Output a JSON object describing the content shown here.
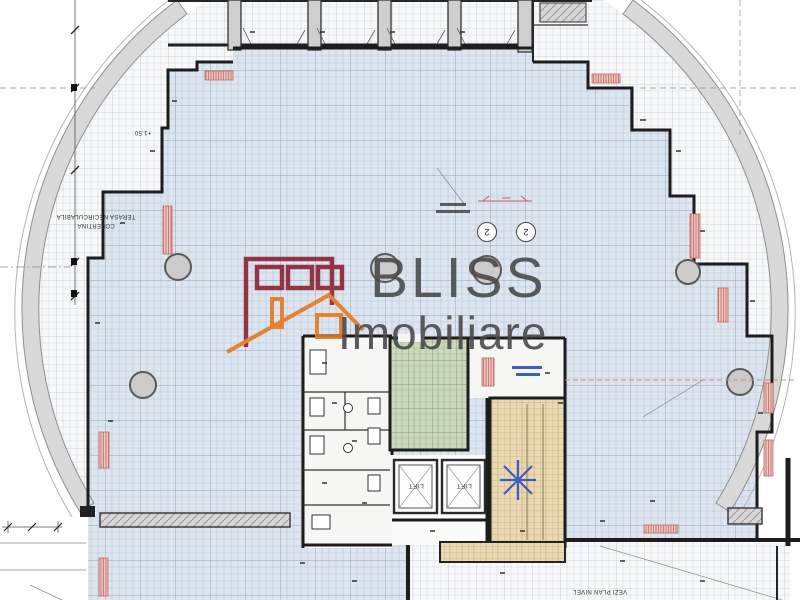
{
  "watermark": {
    "brand": "BLISS",
    "subtitle": "Imobiliare",
    "text_color": "#4a4a4a",
    "buildings_icon_color": "#8b2332",
    "house_icon_color": "#e8791e"
  },
  "plan": {
    "labels": {
      "terrace_line1": "COPERTINA",
      "terrace_line2": "TERASA NECIRCULABILA",
      "elevation": "+1.50",
      "lift": "LIFT",
      "level_note": "VEZI PLAN NIVEL"
    },
    "grid_bubbles": [
      {
        "label": "2"
      },
      {
        "label": "2"
      }
    ],
    "colors": {
      "office_fill": "#dde5ef",
      "office_grid": "#b9c6da",
      "office_grid_strong": "#92a3bb",
      "terrace_fill": "#f7f8fa",
      "terrace_grid": "#d6dade",
      "terrace_grid_strong": "#c2c6cc",
      "green_fill": "#cdd9bd",
      "green_grid": "#9db387",
      "stair_fill": "#ead9b2",
      "stair_line": "#c4ad7e",
      "radiator_fill": "#f0c5c2",
      "radiator_line": "#c06a62",
      "wall": "#1d1d1d",
      "wall_band": "#d9d9d9",
      "column": "#cbcbcb",
      "north_arrow": "#3f5fc0",
      "pink_dash": "#d08a8a"
    }
  }
}
